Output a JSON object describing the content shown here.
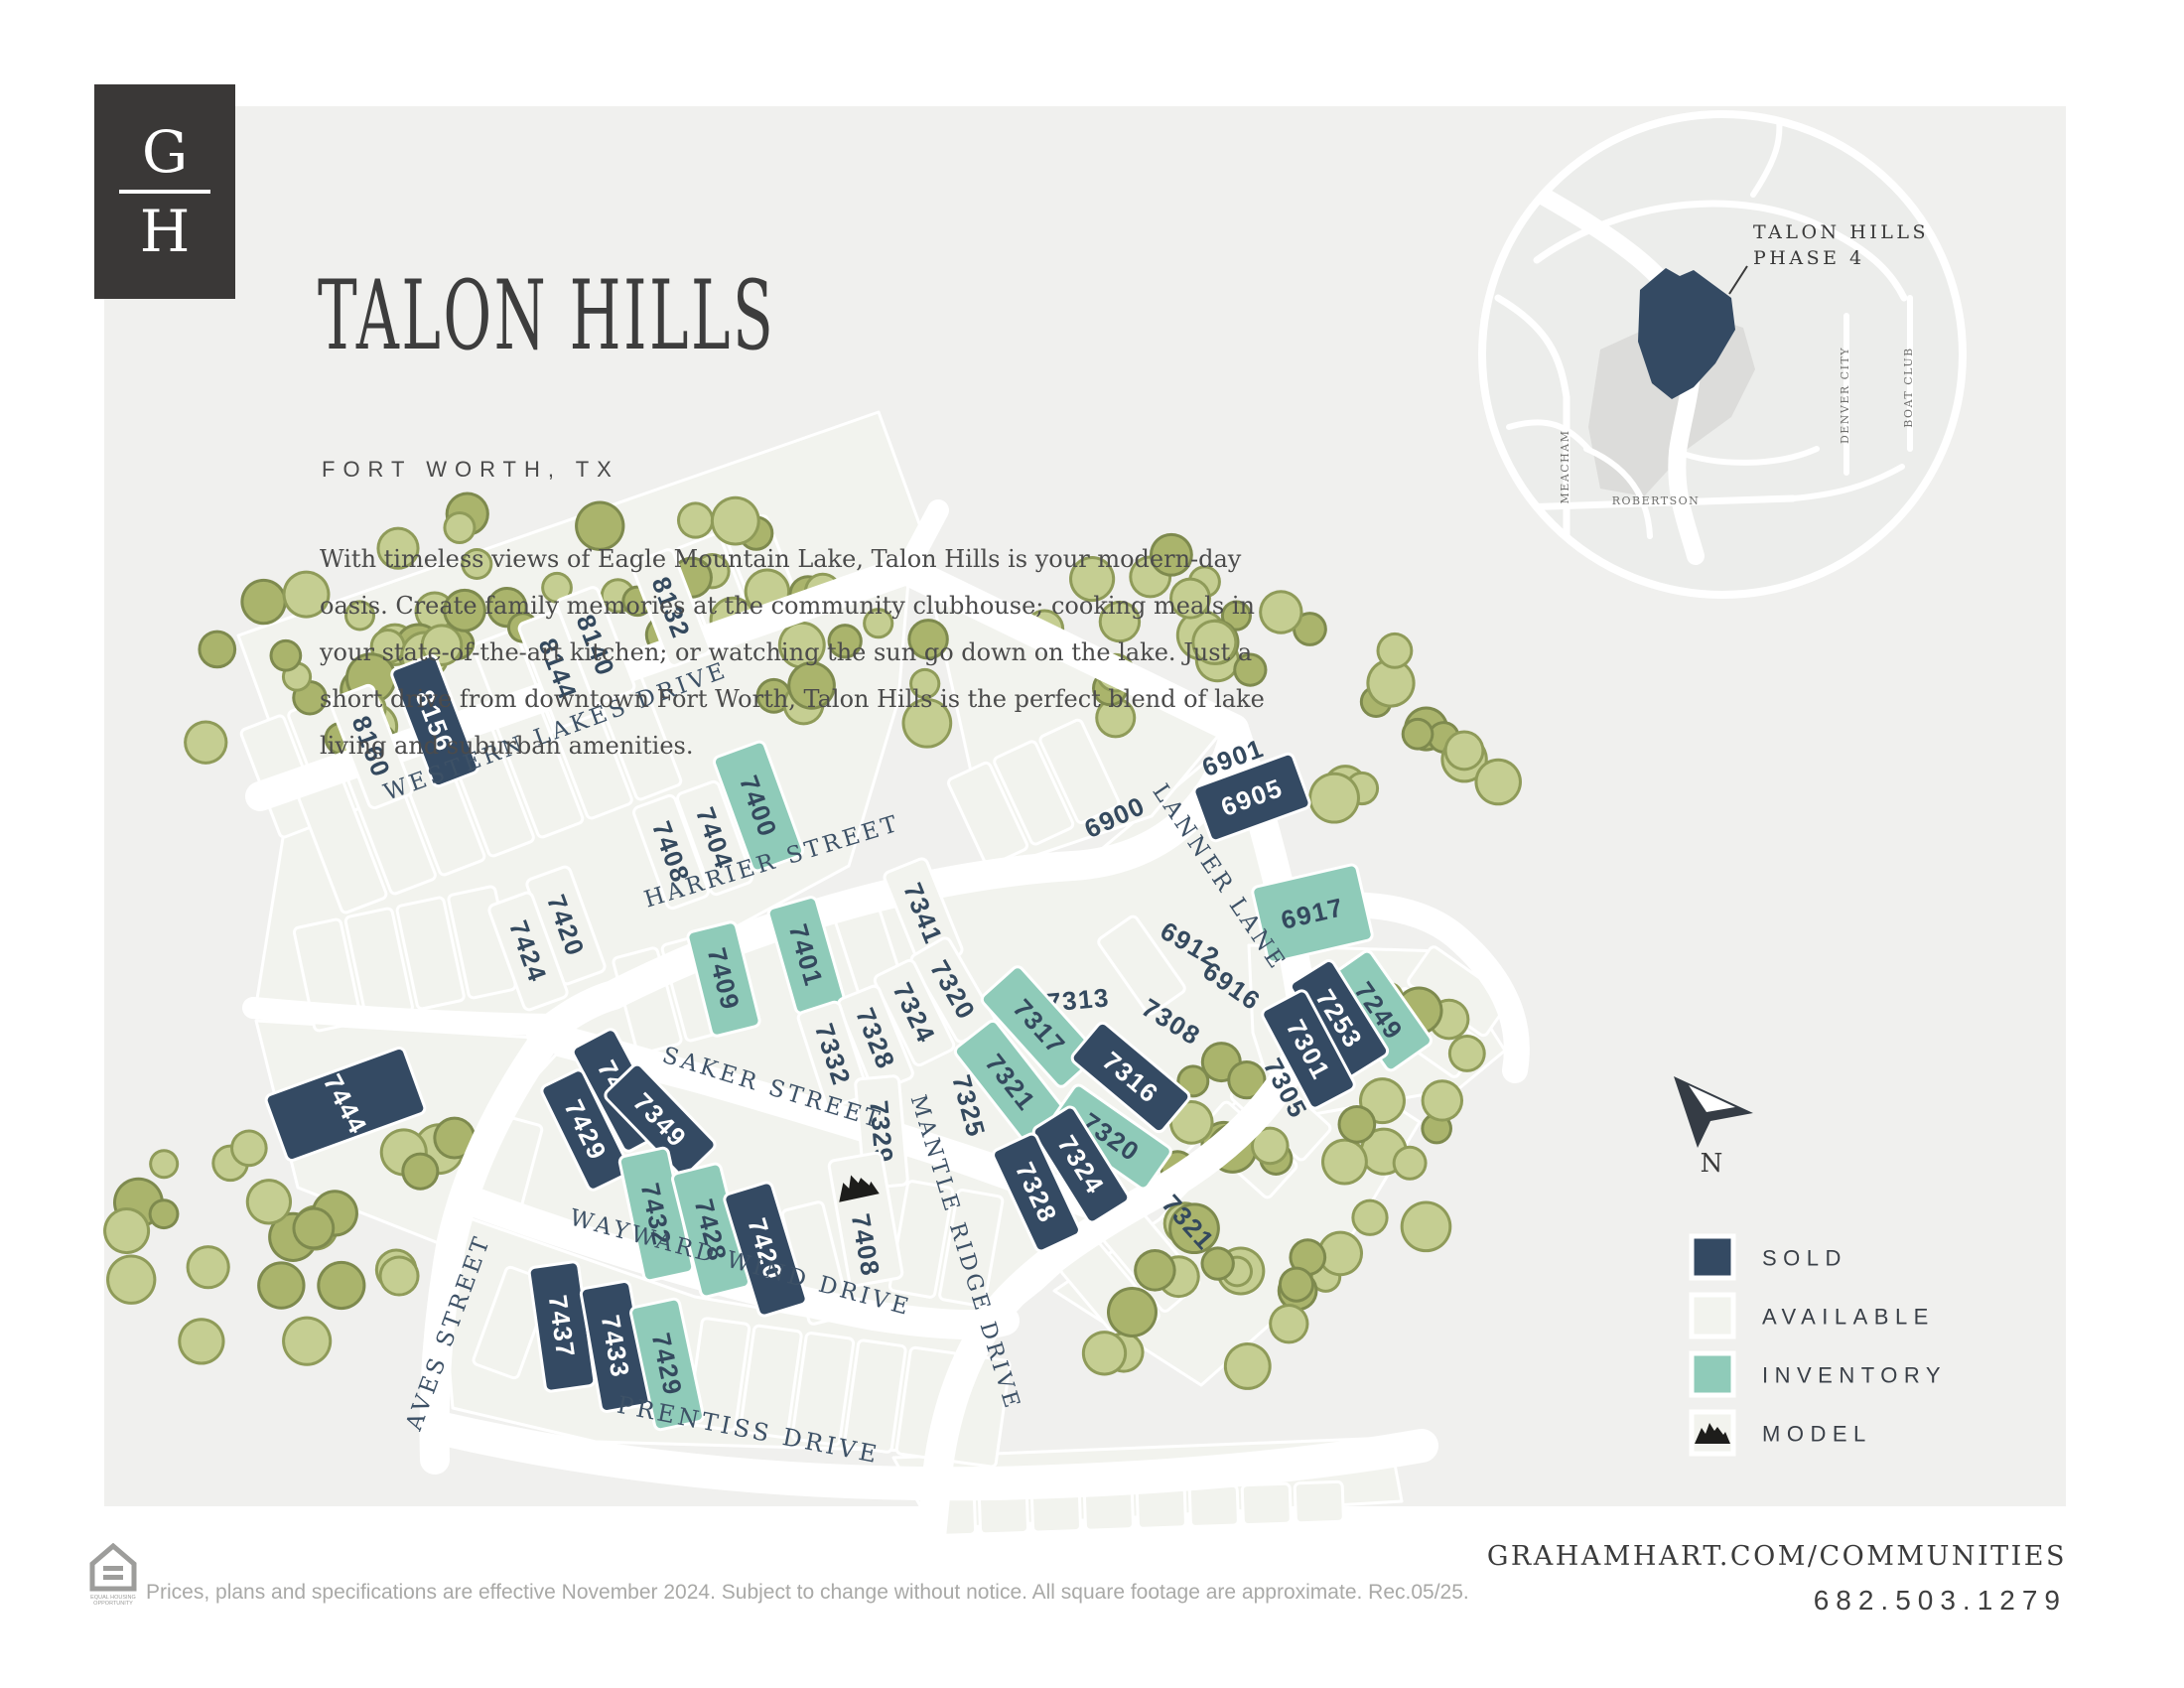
{
  "header": {
    "logo_top": "G",
    "logo_bottom": "H",
    "title": "TALON HILLS",
    "subtitle": "FORT WORTH, TX",
    "description": "With timeless views of Eagle Mountain Lake, Talon Hills is your modern-day oasis. Create family memories at the community clubhouse; cooking meals in your state-of-the-art kitchen; or watching the sun go down on the lake. Just a short drive from downtown Fort Worth, Talon Hills is the perfect blend of lake living and suburban amenities."
  },
  "inset": {
    "label_line1": "TALON HILLS",
    "label_line2": "PHASE 4",
    "streets": [
      "MEACHAM",
      "ROBERTSON",
      "DENVER CITY",
      "BOAT CLUB"
    ]
  },
  "compass": {
    "north_label": "N"
  },
  "legend": {
    "items": [
      {
        "label": "SOLD",
        "type": "sold"
      },
      {
        "label": "AVAILABLE",
        "type": "available"
      },
      {
        "label": "INVENTORY",
        "type": "inventory"
      },
      {
        "label": "MODEL",
        "type": "model"
      }
    ]
  },
  "map": {
    "streets": [
      {
        "name": "WESTERN LAKES DRIVE"
      },
      {
        "name": "HARRIER STREET"
      },
      {
        "name": "SAKER STREET"
      },
      {
        "name": "LANNER LANE"
      },
      {
        "name": "MANTLE RIDGE DRIVE"
      },
      {
        "name": "WAYWARD WIND DRIVE"
      },
      {
        "name": "PRENTISS DRIVE"
      },
      {
        "name": "AVES STREET"
      }
    ],
    "lots": [
      {
        "n": "8160",
        "s": "available"
      },
      {
        "n": "8156",
        "s": "sold"
      },
      {
        "n": "8144",
        "s": "available"
      },
      {
        "n": "8140",
        "s": "available"
      },
      {
        "n": "8132",
        "s": "available"
      },
      {
        "n": "7408",
        "s": "available"
      },
      {
        "n": "7404",
        "s": "available"
      },
      {
        "n": "7400",
        "s": "inventory"
      },
      {
        "n": "7420",
        "s": "available"
      },
      {
        "n": "7424",
        "s": "available"
      },
      {
        "n": "7409",
        "s": "inventory"
      },
      {
        "n": "7401",
        "s": "inventory"
      },
      {
        "n": "7341",
        "s": "available"
      },
      {
        "n": "7320",
        "s": "available"
      },
      {
        "n": "7324",
        "s": "available"
      },
      {
        "n": "7328",
        "s": "available"
      },
      {
        "n": "7332",
        "s": "available"
      },
      {
        "n": "7425",
        "s": "sold"
      },
      {
        "n": "7429",
        "s": "sold"
      },
      {
        "n": "7349",
        "s": "sold"
      },
      {
        "n": "7444",
        "s": "sold"
      },
      {
        "n": "7432",
        "s": "inventory"
      },
      {
        "n": "7428",
        "s": "inventory"
      },
      {
        "n": "7420",
        "s": "sold"
      },
      {
        "n": "7437",
        "s": "sold"
      },
      {
        "n": "7433",
        "s": "sold"
      },
      {
        "n": "7429",
        "s": "inventory"
      },
      {
        "n": "7329",
        "s": "available"
      },
      {
        "n": "7408",
        "s": "model"
      },
      {
        "n": "7313",
        "s": "available"
      },
      {
        "n": "7317",
        "s": "inventory"
      },
      {
        "n": "7321",
        "s": "inventory"
      },
      {
        "n": "7316",
        "s": "sold"
      },
      {
        "n": "7320",
        "s": "inventory"
      },
      {
        "n": "7324",
        "s": "sold"
      },
      {
        "n": "7328",
        "s": "sold"
      },
      {
        "n": "7325",
        "s": "available"
      },
      {
        "n": "7308",
        "s": "available"
      },
      {
        "n": "6916",
        "s": "available"
      },
      {
        "n": "6912",
        "s": "available"
      },
      {
        "n": "6917",
        "s": "inventory"
      },
      {
        "n": "6900",
        "s": "available"
      },
      {
        "n": "6901",
        "s": "available"
      },
      {
        "n": "6905",
        "s": "sold"
      },
      {
        "n": "7249",
        "s": "inventory"
      },
      {
        "n": "7253",
        "s": "sold"
      },
      {
        "n": "7301",
        "s": "sold"
      },
      {
        "n": "7305",
        "s": "available"
      },
      {
        "n": "7321",
        "s": "available"
      }
    ]
  },
  "colors": {
    "sold": "#344a63",
    "available": "#f2f3ee",
    "inventory": "#8fcbb9",
    "road": "#ffffff",
    "panel": "#f0f0ee",
    "lot_text": "#34495e",
    "lot_text_on_sold": "#ffffff",
    "street_text": "#3d5166",
    "tree_fill": "#c5ce92",
    "tree_edge": "#8f9b59",
    "tree_fill_dark": "#aab46c",
    "tree_edge_dark": "#7e8a4e",
    "inset_bg": "#ecedeb",
    "inset_built": "#dcdcda",
    "model_icon": "#1d1d1b"
  },
  "footer": {
    "disclaimer": "Prices, plans and specifications are effective November 2024. Subject to change without notice. All square footage are approximate. Rec.05/25.",
    "eho_line1": "EQUAL HOUSING",
    "eho_line2": "OPPORTUNITY",
    "url": "GRAHAMHART.COM/COMMUNITIES",
    "phone": "682.503.1279"
  }
}
